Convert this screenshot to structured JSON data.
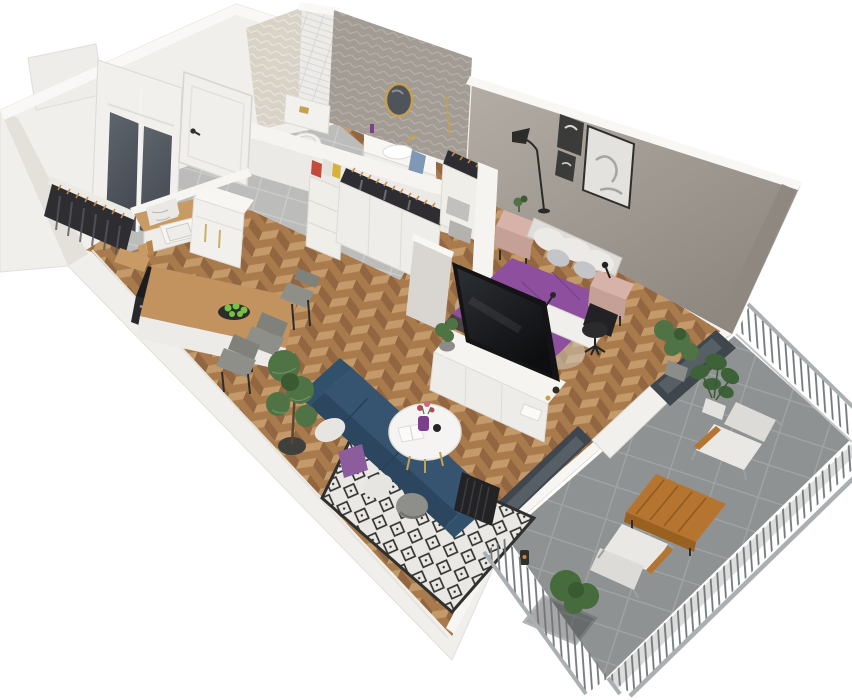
{
  "render": {
    "width": 852,
    "height": 700,
    "background": "#ffffff",
    "type": "isometric-3d-floorplan-render"
  },
  "scene": {
    "subject": "one-bedroom apartment with balcony, cutaway 3D floor plan",
    "rooms": [
      {
        "name": "hallway",
        "floor": "gray-tile",
        "items": [
          "entry-door",
          "sliding-glass-wardrobe",
          "coat-rack-with-hanging-clothes"
        ]
      },
      {
        "name": "bathroom",
        "walls": "herringbone-tile",
        "items": [
          "toilet",
          "vanity-sink",
          "round-gold-mirror",
          "blue-towel",
          "white-tile-column"
        ]
      },
      {
        "name": "kitchen-dining",
        "floor": "herringbone-parquet",
        "items": [
          "sink-counter",
          "gold-faucet",
          "tall-fridge-cabinet",
          "stove-oven",
          "wood-countertop",
          "cutting-boards",
          "dining-peninsula",
          "bar-stool",
          "dining-chairs",
          "plate-of-green-apples",
          "potted-pine-plant"
        ]
      },
      {
        "name": "walk-in-closet",
        "items": [
          "open-wardrobe-units",
          "hanging-clothes-rails",
          "storage-boxes",
          "shelf-unit-with-boxes"
        ]
      },
      {
        "name": "living-room",
        "floor": "herringbone-parquet",
        "items": [
          "navy-corner-sofa",
          "throw-pillows",
          "diamond-pattern-rug",
          "round-white-coffee-table",
          "purple-flower-vase",
          "radiator",
          "white-tv-sideboard",
          "television",
          "half-wall-partition"
        ]
      },
      {
        "name": "bedroom",
        "walls": "warm-gray",
        "items": [
          "double-bed-purple-bedding",
          "upholstered-headboard",
          "white-gray-pillows",
          "pink-nightstand-left",
          "pink-nightstand-right",
          "floor-lamp",
          "wall-art-frames-x3",
          "desk",
          "black-office-chair",
          "potted-plant"
        ]
      },
      {
        "name": "balcony",
        "floor": "concrete-tile",
        "items": [
          "metal-baluster-railing",
          "lounge-chair-upper",
          "lounge-chair-lower",
          "wooden-coffee-table",
          "monstera-plant",
          "shrub-in-planter",
          "small-lantern",
          "anthracite-balcony-door",
          "anthracite-window"
        ]
      }
    ]
  },
  "palette": {
    "bg": "#ffffff",
    "wallWhite": "#f1efec",
    "wallBright": "#f9f8f6",
    "wallShade": "#e4e1db",
    "wallGray1": "#b3ada6",
    "wallGray2": "#8c867e",
    "wallGrayInner": "#8e8880",
    "bathBeige": "#d9d3c7",
    "bathGray": "#a29c94",
    "brickWhite": "#ecebe7",
    "parquetBase": "#a87a4c",
    "parquetLight": "#c49a6a",
    "parquetDark": "#916640",
    "tileBase": "#bcbcba",
    "tileLine": "#cdcdcb",
    "balcTileBase": "#8e9292",
    "balcTileLine": "#a1a5a5",
    "rugWhite": "#e9e8e4",
    "rugBlack": "#30302e",
    "sofaNavy": "#36546f",
    "sofaNavyDark": "#2c4660",
    "cushionPurple": "#8c5d9c",
    "cushionWhite": "#e6e5e1",
    "cushionGray": "#8e8e8a",
    "bedPurple": "#8e4f9e",
    "bedPurpleDark": "#773e86",
    "headboard": "#deddd9",
    "pillowWhite": "#eceae7",
    "pillowGray": "#c3c5c9",
    "nightstand": "#c5a096",
    "nightstandTop": "#d6b2a8",
    "woodCounter": "#c79a66",
    "woodTable": "#c2935f",
    "balconyWood": "#b5742f",
    "stoveTop": "#1d1d1f",
    "ovenFront": "#29292b",
    "chairGray": "#8f8f8a",
    "chairGrayDark": "#81817c",
    "consoleWhite": "#eeece9",
    "tvBlack": "#141416",
    "plantGreen": "#4f7345",
    "plantDark": "#3a5a31",
    "potDark": "#3f3f3b",
    "doorWhite": "#f1efec",
    "glassDark": "#454a52",
    "frameDark": "#40464d",
    "glassPane": "#5b636b",
    "railGray": "#aab0b2",
    "baluster": "#70767a",
    "gold": "#c3a14f",
    "clothesDark": "#2e2e32",
    "clothesAccent": "#c9893f",
    "mirrorGlass": "#4f545a",
    "artDark": "#3b3b39",
    "artLight": "#e3e2de",
    "towelBlue": "#7e98b6",
    "apples": "#79c048",
    "cerealRed": "#c44a3c",
    "cerealYellow": "#d8b13a"
  }
}
